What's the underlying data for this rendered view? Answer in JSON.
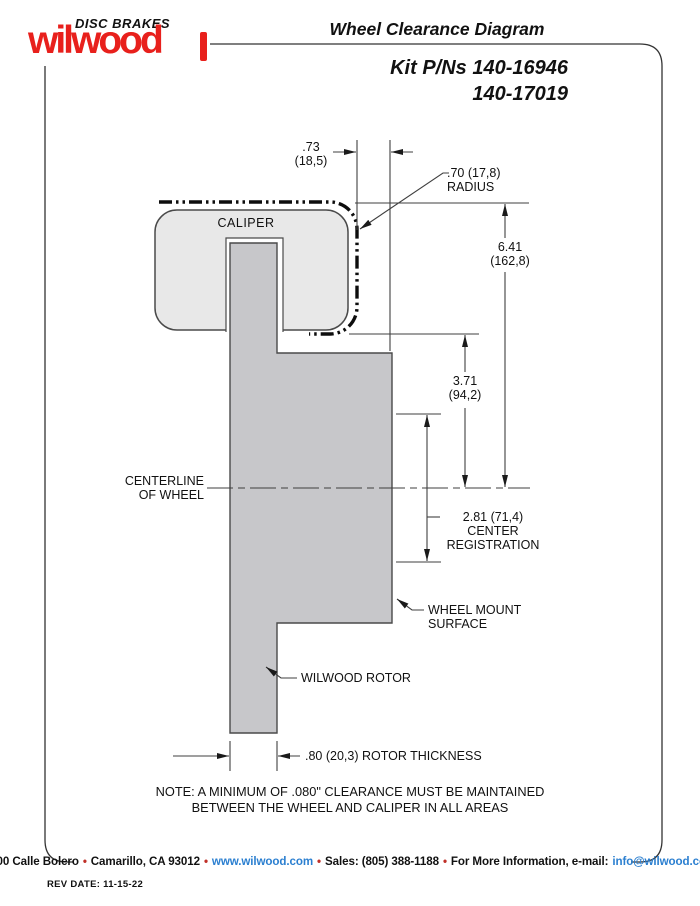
{
  "logo": {
    "brand": "wilwood",
    "tagline": "DISC BRAKES"
  },
  "header": {
    "title": "Wheel Clearance Diagram",
    "kit_line1": "Kit P/Ns 140-16946",
    "kit_line2": "140-17019"
  },
  "diagram": {
    "caliper_label": "CALIPER",
    "dim_caliper_offset": {
      "inch": ".73",
      "mm": "(18,5)"
    },
    "radius": {
      "line1": ".70 (17,8)",
      "line2": "RADIUS"
    },
    "dim_overall": {
      "inch": "6.41",
      "mm": "(162,8)"
    },
    "dim_caliper_to_center": {
      "inch": "3.71",
      "mm": "(94,2)"
    },
    "centerline": {
      "line1": "CENTERLINE",
      "line2": "OF WHEEL"
    },
    "center_registration": {
      "line1": "2.81 (71,4)",
      "line2": "CENTER",
      "line3": "REGISTRATION"
    },
    "wheel_mount": {
      "line1": "WHEEL MOUNT",
      "line2": "SURFACE"
    },
    "rotor_label": "WILWOOD ROTOR",
    "rotor_thickness": ".80 (20,3) ROTOR THICKNESS",
    "note_line1": "NOTE: A MINIMUM OF .080\" CLEARANCE MUST BE MAINTAINED",
    "note_line2": "BETWEEN THE WHEEL AND CALIPER IN ALL AREAS"
  },
  "footer": {
    "address": "4700 Calle Bolero",
    "city": "Camarillo, CA 93012",
    "web": "www.wilwood.com",
    "sales": "Sales: (805) 388-1188",
    "more": "For More Information, e-mail:",
    "email": "info@wilwood.com",
    "bullet": "•",
    "rev": "REV DATE:  11-15-22"
  },
  "colors": {
    "brand_red": "#e8201c",
    "link_blue": "#2b7fd0",
    "caliper_fill": "#e8e8e8",
    "rotor_fill": "#c7c7ca",
    "line_dark": "#3f3f3f"
  }
}
